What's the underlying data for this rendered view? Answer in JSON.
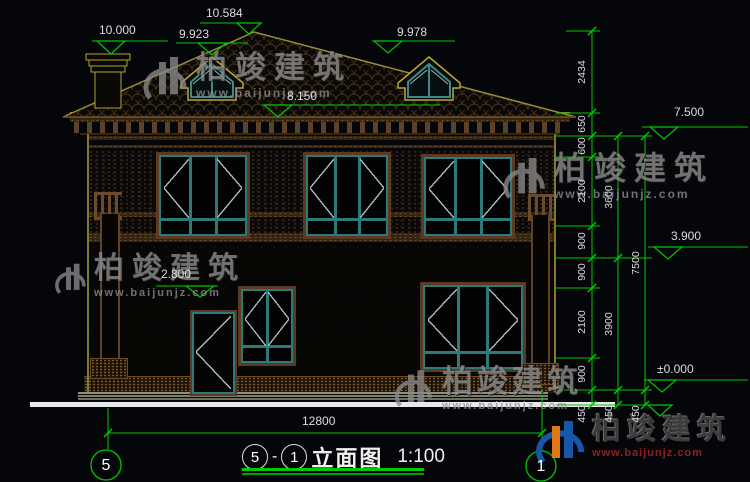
{
  "watermark": {
    "name": "柏竣建筑",
    "url": "www.baijunjz.com"
  },
  "markers": {
    "ridge": "10.584",
    "chimney": "10.000",
    "dormer_left": "9.923",
    "dormer_right": "9.978",
    "eave": "8.150",
    "eave_right": "7.500",
    "sill_level": "3.900",
    "zero_level": "±0.000",
    "porch": "2.800"
  },
  "dims": {
    "overall_width": "12800",
    "chain_inner": [
      "2434",
      "650",
      "600",
      "2100",
      "900",
      "900",
      "2100",
      "900",
      "450"
    ],
    "chain_middle": [
      "3600",
      "3900",
      "450"
    ],
    "chain_outer": [
      "7500",
      "450"
    ]
  },
  "grid": {
    "left": "5",
    "right": "1"
  },
  "title": {
    "left_num": "5",
    "dash": "-",
    "right_num": "1",
    "name": "立面图",
    "scale": "1:100"
  },
  "colors": {
    "dim_green": "#00c800",
    "frame_teal": "#2e7a7a",
    "trim_brown": "#5a3a22",
    "outline_yellow": "#9a8a3a",
    "ground_white": "#e8e8e8",
    "logo_blue": "#1857a8",
    "logo_orange": "#e07818",
    "watermark_gray": "#909090",
    "url_red": "#8a2222"
  }
}
